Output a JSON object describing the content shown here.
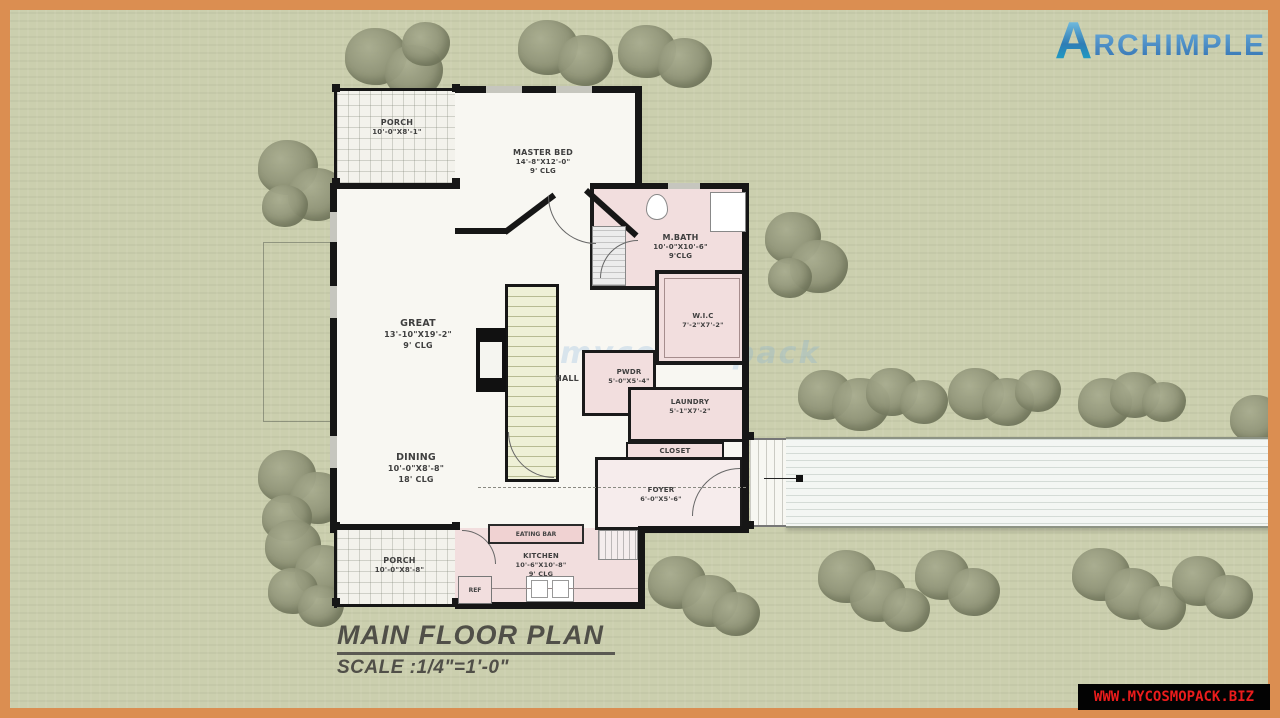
{
  "branding": {
    "logo_a": "A",
    "logo_rest": "RCHIMPLE"
  },
  "site_watermark": "WWW.MYCOSMOPACK.BIZ",
  "faint_watermark": "mycosmopack",
  "title_block": {
    "title": "MAIN FLOOR PLAN",
    "scale": "SCALE :1/4\"=1'-0\""
  },
  "rooms": {
    "porch_top": {
      "name": "PORCH",
      "dims": "10'-0\"X8'-1\""
    },
    "master_bed": {
      "name": "MASTER BED",
      "dims": "14'-8\"X12'-0\"",
      "clg": "9' CLG"
    },
    "m_bath": {
      "name": "M.BATH",
      "dims": "10'-0\"X10'-6\"",
      "clg": "9'CLG"
    },
    "wic": {
      "name": "W.I.C",
      "dims": "7'-2\"X7'-2\""
    },
    "great": {
      "name": "GREAT",
      "dims": "13'-10\"X19'-2\"",
      "clg": "9' CLG"
    },
    "hall": {
      "name": "HALL"
    },
    "pwdr": {
      "name": "PWDR",
      "dims": "5'-0\"X5'-4\""
    },
    "laundry": {
      "name": "LAUNDRY",
      "dims": "5'-1\"X7'-2\""
    },
    "closet": {
      "name": "CLOSET"
    },
    "dining": {
      "name": "DINING",
      "dims": "10'-0\"X8'-8\"",
      "clg": "18' CLG"
    },
    "foyer": {
      "name": "FOYER",
      "dims": "6'-0\"X5'-6\""
    },
    "eating_bar": {
      "name": "EATING BAR"
    },
    "kitchen": {
      "name": "KITCHEN",
      "dims": "10'-6\"X10'-8\"",
      "clg": "9' CLG"
    },
    "ref": {
      "name": "REF"
    },
    "porch_bottom": {
      "name": "PORCH",
      "dims": "10'-0\"X8'-8\""
    }
  },
  "colors": {
    "frame": "#db8e51",
    "grass": "#cbcfae",
    "wall": "#161616",
    "room_pink": "#f2dede",
    "room_white": "#f8f7f2",
    "watermark_red": "#ea1c1c",
    "logo_blue": "#2f7db5"
  }
}
